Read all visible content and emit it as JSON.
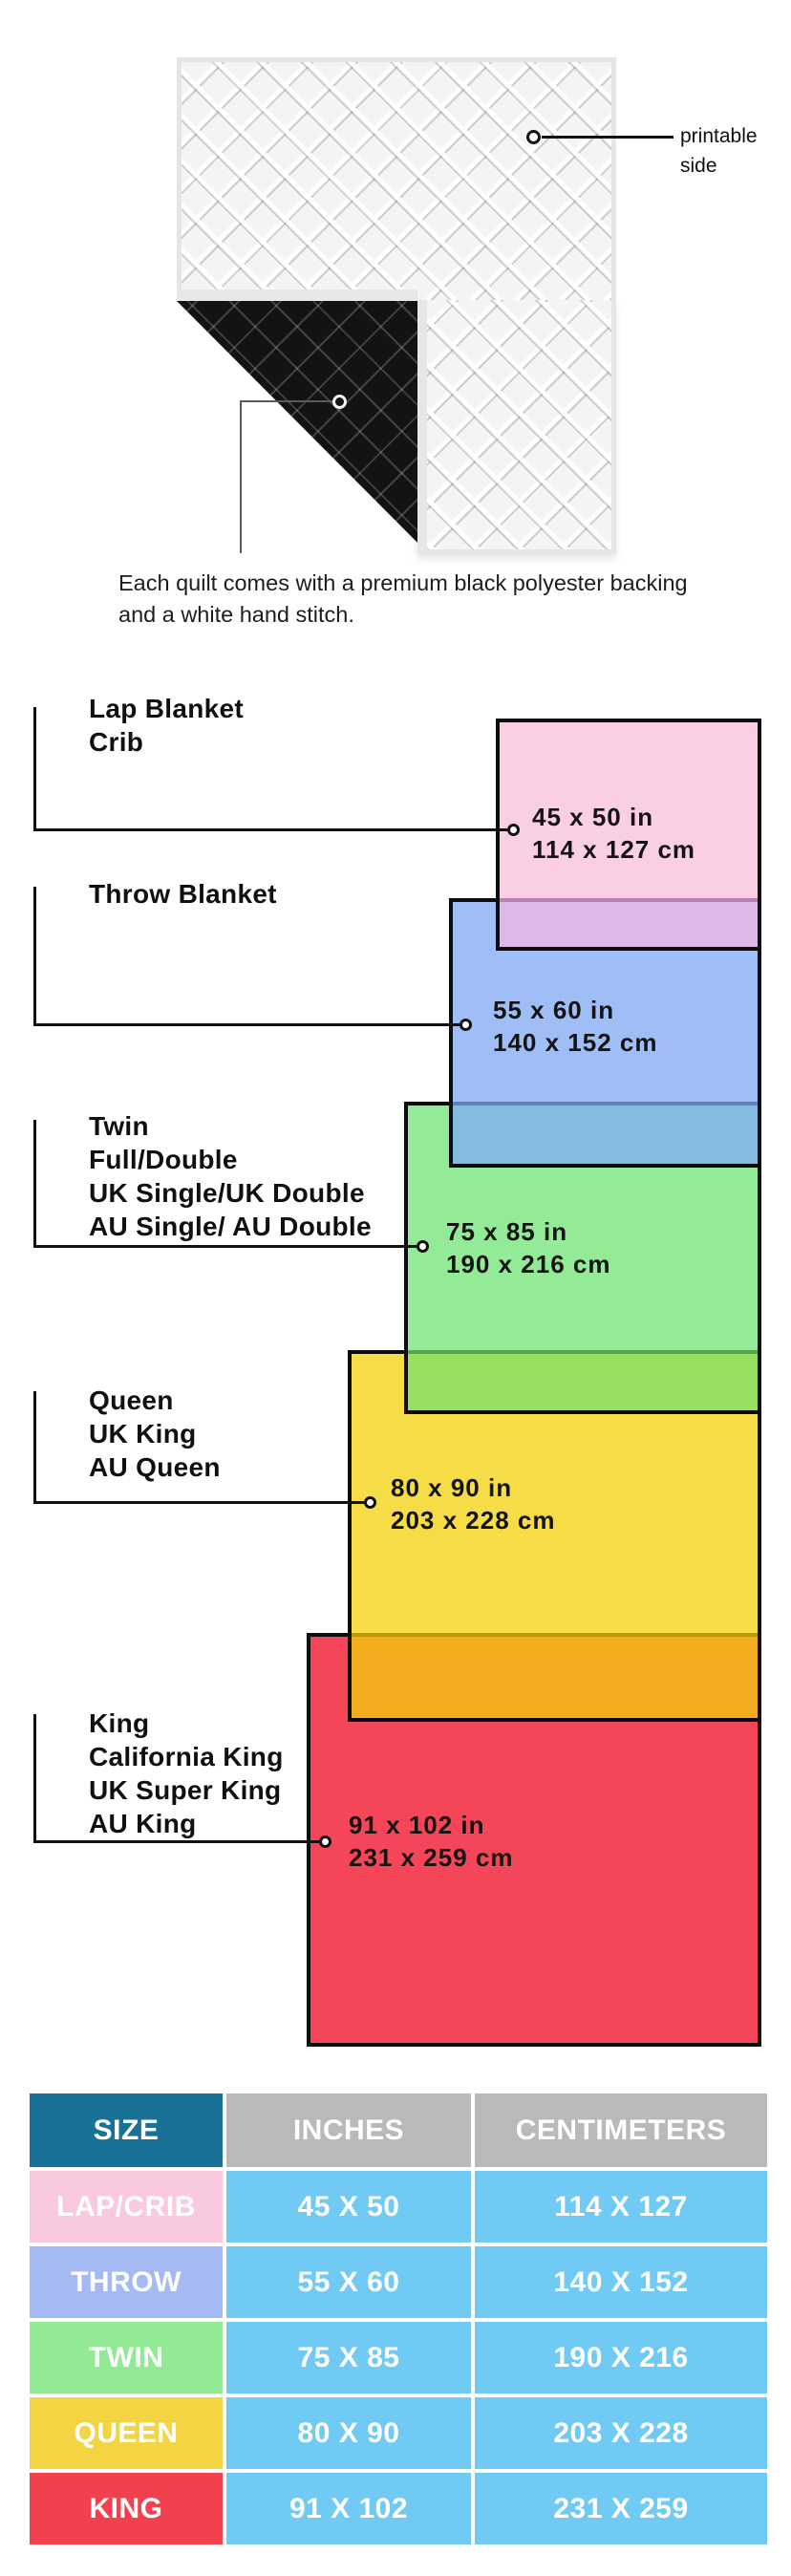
{
  "hero": {
    "printable_label": "printable side",
    "caption": "Each quilt comes with a premium black polyester backing and a white hand stitch.",
    "front_color": "#f4f4f4",
    "backing_color": "#131313",
    "binding_color": "#e6e6e6"
  },
  "diagram": {
    "border_color": "#0d0d0d",
    "sizes": [
      {
        "key": "lap",
        "labels": [
          "Lap Blanket",
          "Crib"
        ],
        "inches": "45 x 50 in",
        "centimeters": "114 x 127 cm",
        "fill": "#FBCFE3"
      },
      {
        "key": "throw",
        "labels": [
          "Throw Blanket"
        ],
        "inches": "55 x 60 in",
        "centimeters": "140 x 152 cm",
        "fill": "#9FBEF6"
      },
      {
        "key": "twin",
        "labels": [
          "Twin",
          "Full/Double",
          "UK Single/UK Double",
          "AU Single/ AU Double"
        ],
        "inches": "75 x 85 in",
        "centimeters": "190 x 216 cm",
        "fill": "#93EB97"
      },
      {
        "key": "queen",
        "labels": [
          "Queen",
          "UK King",
          "AU Queen"
        ],
        "inches": "80 x 90 in",
        "centimeters": "203 x 228 cm",
        "fill": "#F6DC47"
      },
      {
        "key": "king",
        "labels": [
          "King",
          "California King",
          "UK Super King",
          "AU King"
        ],
        "inches": "91 x 102 in",
        "centimeters": "231 x 259 cm",
        "fill": "#F54558"
      }
    ],
    "overlaps": [
      {
        "pair": "lap-over-throw",
        "fill": "#DCB9E6",
        "line": "#BB7FB2"
      },
      {
        "pair": "throw-over-twin",
        "fill": "#85BBE0",
        "line": "#5F83B8"
      },
      {
        "pair": "twin-over-queen",
        "fill": "#97E05F",
        "line": "#55A84A"
      },
      {
        "pair": "queen-over-king",
        "fill": "#F3AE1F",
        "line": "#BA990F"
      }
    ]
  },
  "table": {
    "headers": {
      "size": "SIZE",
      "inches": "INCHES",
      "centimeters": "CENTIMETERS"
    },
    "header_colors": {
      "size_bg": "#1A7196",
      "metrics_bg": "#B9B9B9"
    },
    "value_bg": "#70CAF3",
    "rows": [
      {
        "size": "LAP/CRIB",
        "inches": "45 X 50",
        "centimeters": "114 X 127",
        "color": "#F9C9DE"
      },
      {
        "size": "THROW",
        "inches": "55 X 60",
        "centimeters": "140 X 152",
        "color": "#A5BAF3"
      },
      {
        "size": "TWIN",
        "inches": "75 X 85",
        "centimeters": "190 X 216",
        "color": "#92EB94"
      },
      {
        "size": "QUEEN",
        "inches": "80 X 90",
        "centimeters": "203 X 228",
        "color": "#F3D544"
      },
      {
        "size": "KING",
        "inches": "91 X 102",
        "centimeters": "231 X 259",
        "color": "#F1414F"
      }
    ]
  }
}
